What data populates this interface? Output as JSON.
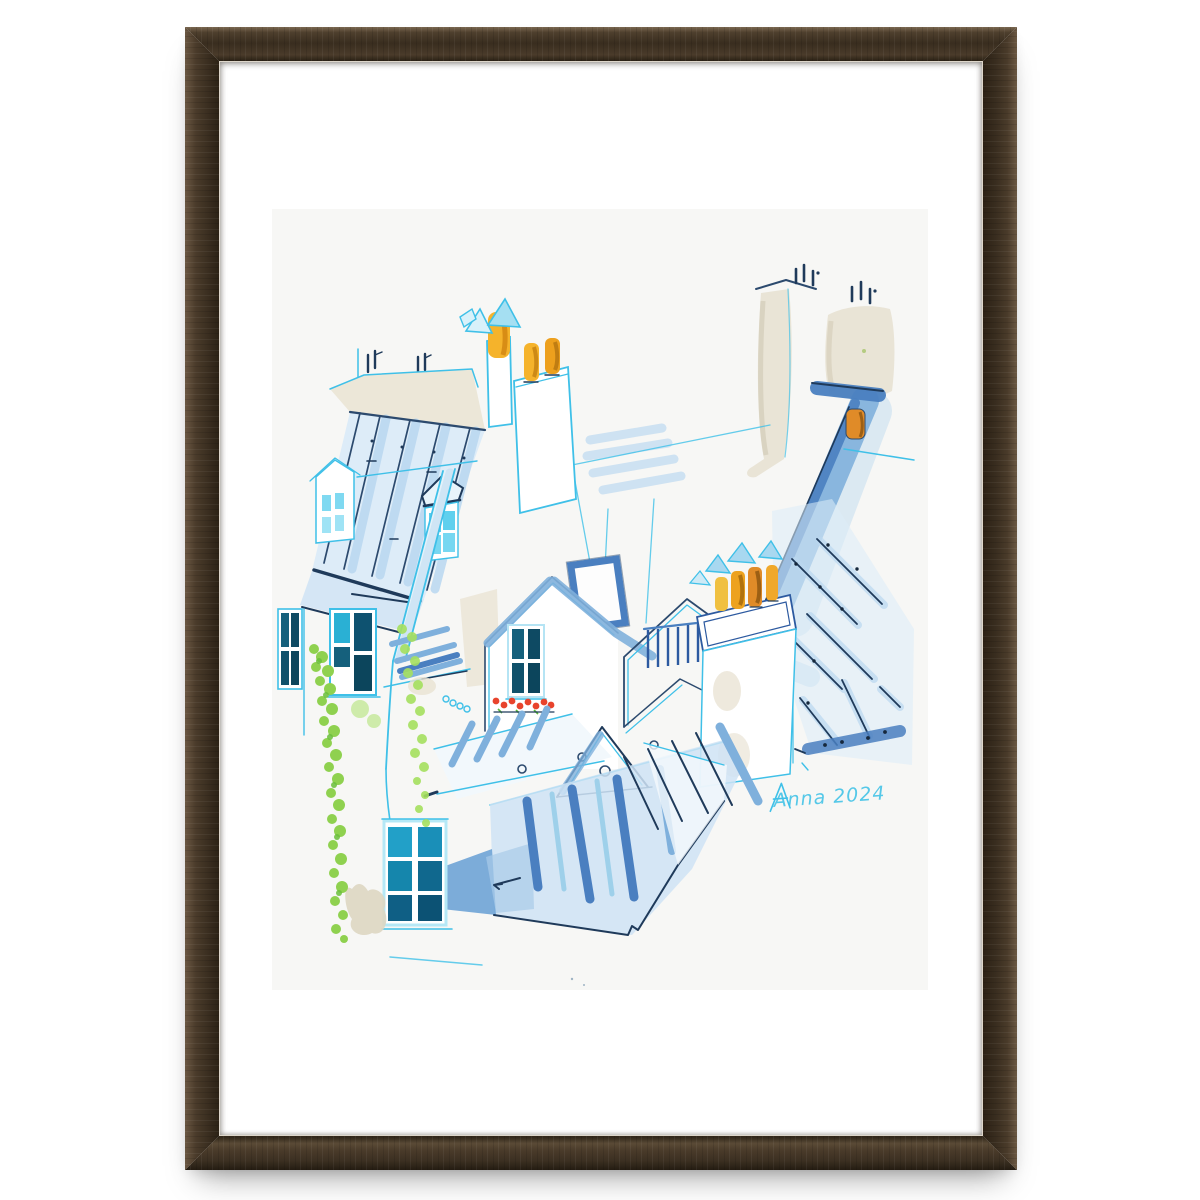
{
  "artwork": {
    "signature_text": "Anna 2024",
    "description": "Watercolor painting of Paris rooftops with chimneys, dormer windows, ivy and flower box, in a dark walnut wood frame with white mat"
  },
  "palette": {
    "ink_navy": "#2c4a6e",
    "ink_dark": "#1f3a5a",
    "sky_cyan": "#3fc0e8",
    "wash_pale": "#ddecf8",
    "wash_light": "#b9d7f0",
    "wash_mid": "#7fb0dc",
    "wash_deep": "#4a7fc0",
    "window_teal": "#15607c",
    "window_teal_dark": "#0e4a63",
    "window_cyan": "#5fd0ee",
    "pot_yellow": "#f5b32b",
    "pot_orange": "#e08b28",
    "beige": "#e9e4d6",
    "ivy_green": "#8fd14f",
    "ivy_green_dark": "#6abf3a",
    "flower_red": "#e8432c",
    "signature_cyan": "#55c8e8",
    "frame_wood_dark": "#392d1f",
    "frame_wood_mid": "#4a3b2a",
    "frame_wood_light": "#7a6750",
    "mat_white": "#ffffff",
    "paper_white": "#f7f7f5"
  }
}
